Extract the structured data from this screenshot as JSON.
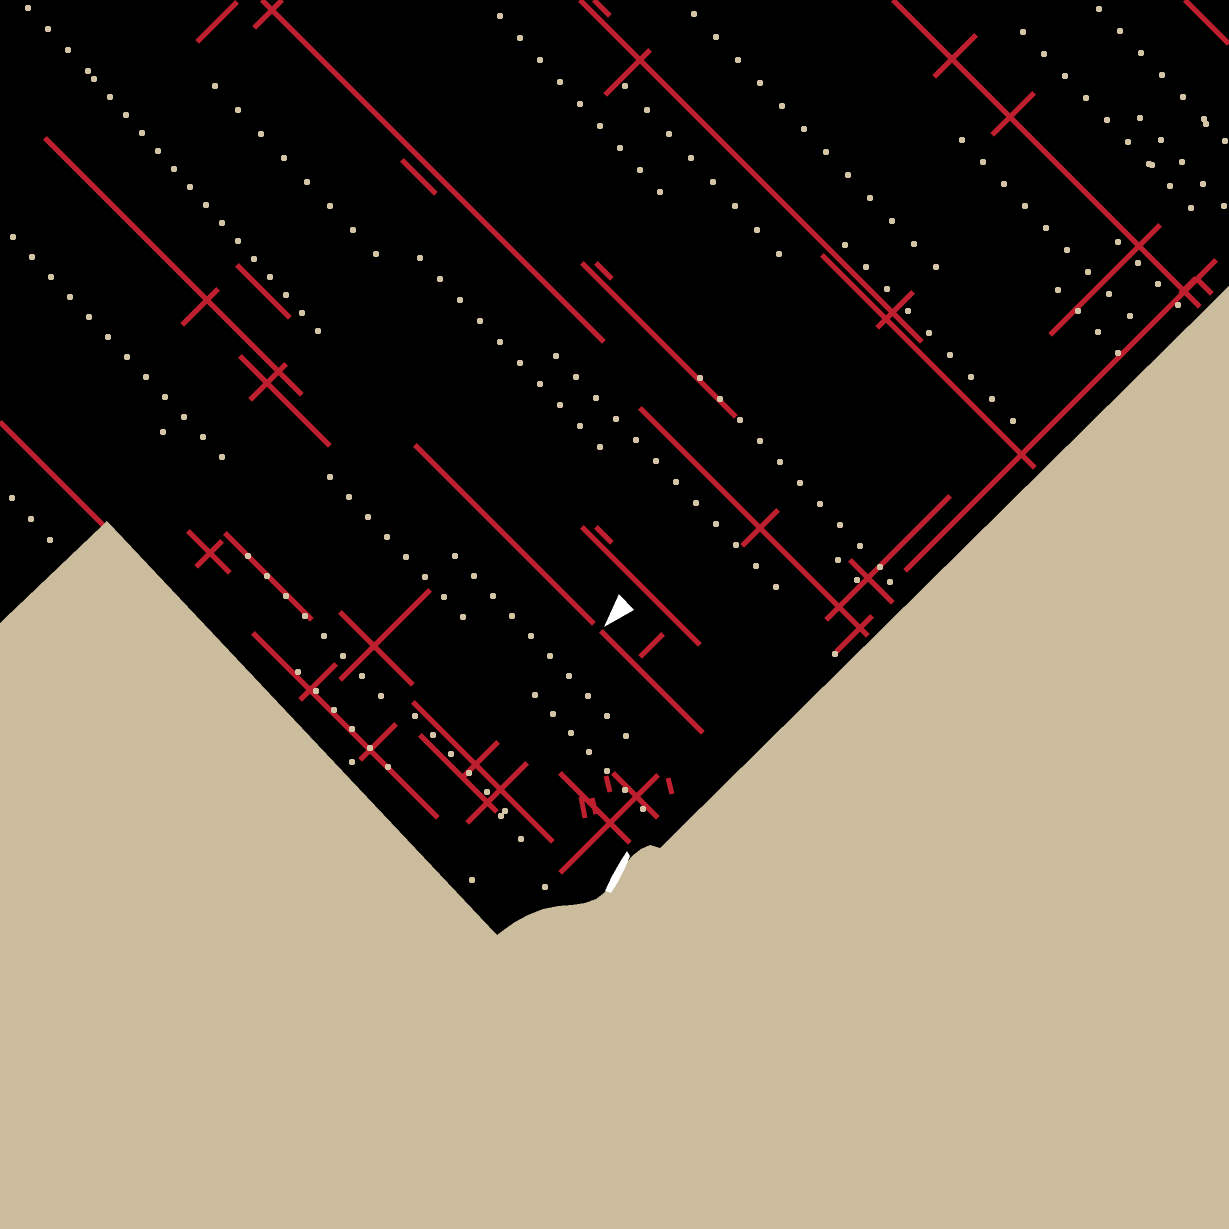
{
  "canvas": {
    "width": 1229,
    "height": 1229
  },
  "colors": {
    "background": "#cabc9d",
    "land": "#000000",
    "road": "#bd1f2e",
    "dot": "#d3c4a5",
    "marker": "#ffffff",
    "shore_patch": "#ffffff"
  },
  "land_polygon": [
    [
      0,
      0
    ],
    [
      1229,
      0
    ],
    [
      1229,
      286
    ],
    [
      660,
      848
    ],
    [
      650,
      845
    ],
    [
      641,
      849
    ],
    [
      632,
      856
    ],
    [
      624,
      866
    ],
    [
      618,
      875
    ],
    [
      612,
      884
    ],
    [
      604,
      893
    ],
    [
      596,
      899
    ],
    [
      585,
      903
    ],
    [
      572,
      905
    ],
    [
      558,
      906
    ],
    [
      543,
      909
    ],
    [
      528,
      915
    ],
    [
      515,
      922
    ],
    [
      505,
      929
    ],
    [
      497,
      935
    ],
    [
      107,
      521
    ],
    [
      0,
      623
    ]
  ],
  "roads": {
    "stroke_width": 5,
    "segments": [
      [
        262,
        0,
        604,
        342
      ],
      [
        594,
        0,
        610,
        16
      ],
      [
        580,
        0,
        922,
        342
      ],
      [
        893,
        0,
        1200,
        307
      ],
      [
        1185,
        0,
        1229,
        44
      ],
      [
        45,
        138,
        302,
        395
      ],
      [
        0,
        422,
        103,
        525
      ],
      [
        402,
        160,
        436,
        194
      ],
      [
        415,
        445,
        594,
        624
      ],
      [
        601,
        631,
        703,
        733
      ],
      [
        582,
        263,
        736,
        417
      ],
      [
        596,
        263,
        612,
        279
      ],
      [
        640,
        408,
        868,
        636
      ],
      [
        582,
        527,
        700,
        645
      ],
      [
        596,
        527,
        612,
        543
      ],
      [
        340,
        612,
        413,
        685
      ],
      [
        413,
        702,
        553,
        842
      ],
      [
        253,
        633,
        438,
        818
      ],
      [
        225,
        533,
        312,
        620
      ],
      [
        188,
        531,
        230,
        573
      ],
      [
        240,
        356,
        330,
        446
      ],
      [
        237,
        265,
        290,
        318
      ],
      [
        822,
        255,
        1035,
        468
      ],
      [
        850,
        560,
        893,
        603
      ],
      [
        1196,
        278,
        1212,
        294
      ],
      [
        560,
        773,
        630,
        843
      ],
      [
        613,
        773,
        658,
        818
      ],
      [
        420,
        735,
        497,
        812
      ],
      [
        581,
        797,
        585,
        818
      ],
      [
        592,
        798,
        596,
        814
      ],
      [
        606,
        776,
        610,
        792
      ],
      [
        668,
        778,
        672,
        794
      ],
      [
        197,
        42,
        237,
        2
      ],
      [
        254,
        28,
        282,
        0
      ],
      [
        605,
        95,
        650,
        50
      ],
      [
        934,
        77,
        976,
        35
      ],
      [
        992,
        135,
        1034,
        93
      ],
      [
        905,
        571,
        1216,
        260
      ],
      [
        826,
        620,
        950,
        496
      ],
      [
        836,
        652,
        872,
        616
      ],
      [
        560,
        873,
        658,
        775
      ],
      [
        640,
        657,
        663,
        634
      ],
      [
        182,
        325,
        218,
        289
      ],
      [
        742,
        546,
        778,
        510
      ],
      [
        877,
        328,
        913,
        292
      ],
      [
        196,
        567,
        222,
        541
      ],
      [
        1050,
        335,
        1160,
        225
      ],
      [
        250,
        400,
        286,
        364
      ],
      [
        300,
        700,
        336,
        664
      ],
      [
        360,
        760,
        396,
        724
      ],
      [
        462,
        778,
        498,
        742
      ],
      [
        1180,
        294,
        1196,
        278
      ],
      [
        340,
        680,
        430,
        590
      ],
      [
        467,
        823,
        527,
        763
      ]
    ]
  },
  "dots": {
    "size": 6,
    "chains": [
      {
        "start": [
          500,
          16
        ],
        "step": [
          20,
          22
        ],
        "count": 9
      },
      {
        "start": [
          694,
          14
        ],
        "step": [
          22,
          23
        ],
        "count": 12
      },
      {
        "start": [
          625,
          86
        ],
        "step": [
          22,
          24
        ],
        "count": 8
      },
      {
        "start": [
          94,
          79
        ],
        "step": [
          16,
          18
        ],
        "count": 15
      },
      {
        "start": [
          215,
          86
        ],
        "step": [
          23,
          24
        ],
        "count": 8
      },
      {
        "start": [
          13,
          237
        ],
        "step": [
          19,
          20
        ],
        "count": 12
      },
      {
        "start": [
          1023,
          32
        ],
        "step": [
          21,
          22
        ],
        "count": 9
      },
      {
        "start": [
          1099,
          9
        ],
        "step": [
          21,
          22
        ],
        "count": 7
      },
      {
        "start": [
          962,
          140
        ],
        "step": [
          21,
          22
        ],
        "count": 9
      },
      {
        "start": [
          845,
          245
        ],
        "step": [
          21,
          22
        ],
        "count": 9
      },
      {
        "start": [
          1118,
          242
        ],
        "step": [
          20,
          21
        ],
        "count": 4
      },
      {
        "start": [
          420,
          258
        ],
        "step": [
          20,
          21
        ],
        "count": 10
      },
      {
        "start": [
          556,
          356
        ],
        "step": [
          20,
          21
        ],
        "count": 12
      },
      {
        "start": [
          700,
          378
        ],
        "step": [
          20,
          21
        ],
        "count": 10
      },
      {
        "start": [
          330,
          477
        ],
        "step": [
          19,
          20
        ],
        "count": 8
      },
      {
        "start": [
          455,
          556
        ],
        "step": [
          19,
          20
        ],
        "count": 10
      },
      {
        "start": [
          248,
          556
        ],
        "step": [
          19,
          20
        ],
        "count": 8
      },
      {
        "start": [
          535,
          695
        ],
        "step": [
          18,
          19
        ],
        "count": 7
      },
      {
        "start": [
          415,
          716
        ],
        "step": [
          18,
          19
        ],
        "count": 6
      },
      {
        "start": [
          298,
          672
        ],
        "step": [
          18,
          19
        ],
        "count": 6
      },
      {
        "start": [
          12,
          498
        ],
        "step": [
          19,
          21
        ],
        "count": 3
      },
      {
        "start": [
          838,
          560
        ],
        "step": [
          19,
          20
        ],
        "count": 2
      },
      {
        "start": [
          1140,
          118
        ],
        "step": [
          21,
          22
        ],
        "count": 5
      },
      {
        "start": [
          28,
          8
        ],
        "step": [
          20,
          21
        ],
        "count": 4
      },
      {
        "start": [
          1058,
          290
        ],
        "step": [
          20,
          21
        ],
        "count": 4
      }
    ],
    "extra": [
      [
        835,
        654
      ],
      [
        890,
        582
      ],
      [
        501,
        816
      ],
      [
        521,
        839
      ],
      [
        545,
        887
      ],
      [
        472,
        880
      ],
      [
        352,
        762
      ],
      [
        163,
        432
      ],
      [
        1206,
        124
      ],
      [
        1152,
        165
      ]
    ]
  },
  "shore_patch": {
    "points": [
      [
        627,
        851
      ],
      [
        620,
        862
      ],
      [
        612,
        876
      ],
      [
        605,
        891
      ],
      [
        611,
        893
      ],
      [
        618,
        882
      ],
      [
        625,
        868
      ],
      [
        630,
        856
      ]
    ]
  },
  "marker": {
    "points": [
      [
        619,
        594
      ],
      [
        634,
        610
      ],
      [
        604,
        627
      ]
    ]
  }
}
